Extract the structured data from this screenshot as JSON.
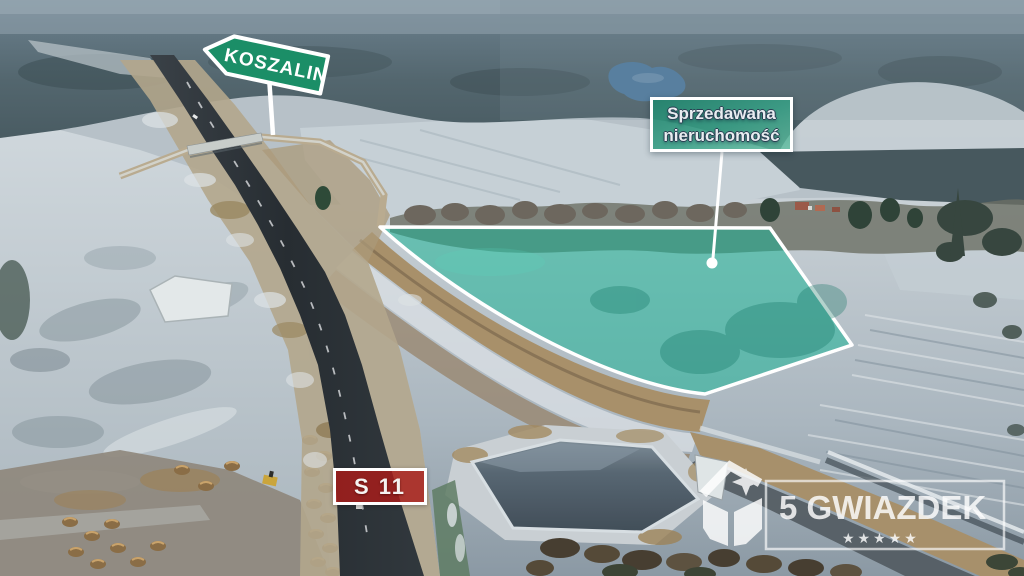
{
  "overlays": {
    "direction_sign": {
      "label": "KOSZALIN",
      "panel_color": "#1b8e67",
      "border_color": "#ffffff"
    },
    "property_label": {
      "line1": "Sprzedawana",
      "line2": "nieruchomość",
      "panel_color": "#2f9c85",
      "border_color": "#ffffff"
    },
    "highlight_area": {
      "fill_color": "#15b394",
      "border_color": "#ffffff"
    },
    "road_sign": {
      "label": "S 11",
      "panel_color": "#aa1c1a",
      "border_color": "#ffffff"
    },
    "watermark": {
      "brand": "5 GWIAZDEK",
      "stars": "★★★★★",
      "color": "#ffffff"
    }
  }
}
